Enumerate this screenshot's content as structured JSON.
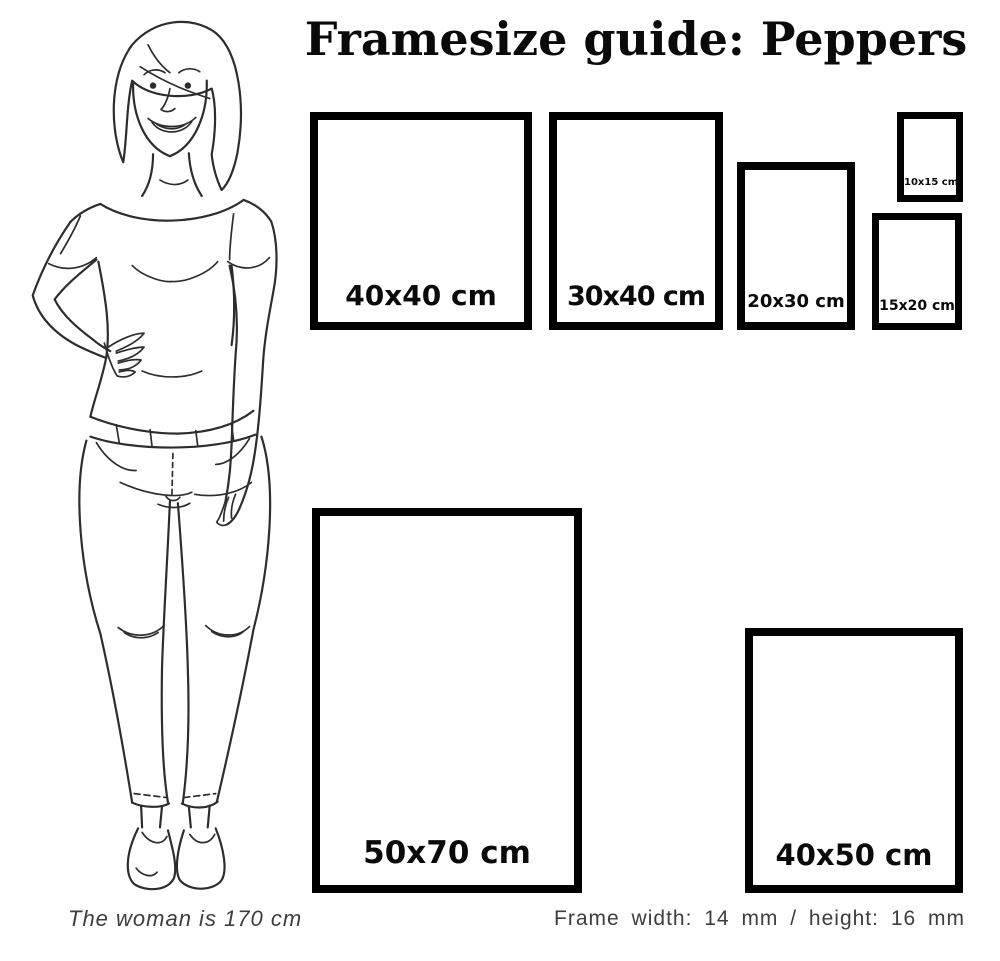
{
  "title": "Framesize guide: Peppers",
  "frames": [
    {
      "label": "40x40 cm"
    },
    {
      "label": "30x40 cm"
    },
    {
      "label": "20x30 cm"
    },
    {
      "label": "10x15 cm"
    },
    {
      "label": "15x20 cm"
    },
    {
      "label": "50x70 cm"
    },
    {
      "label": "40x50 cm"
    }
  ],
  "footer": {
    "woman_caption": "The woman is 170 cm",
    "frame_spec": "Frame width: 14 mm / height: 16 mm"
  },
  "illustration": {
    "name": "woman-line-drawing"
  },
  "colors": {
    "background": "#ffffff",
    "frame_border": "#000000",
    "label_text": "#0a0a0a",
    "caption_text": "#3d3d3d",
    "line_art": "#2d2d2d"
  }
}
